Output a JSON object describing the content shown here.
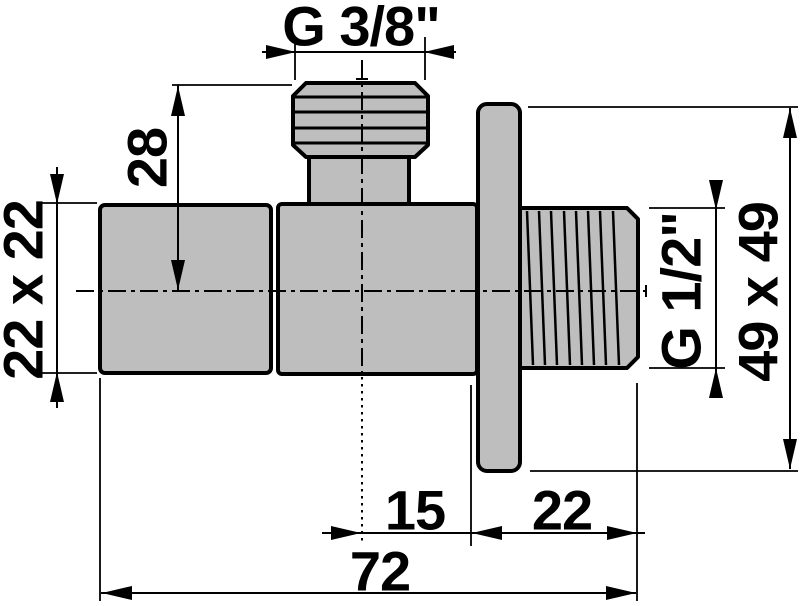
{
  "drawing": {
    "title": "Angle valve technical drawing",
    "labels": {
      "thread_top": "G 3/8\"",
      "dim_height_28": "28",
      "dim_body_22x22": "22 x 22",
      "thread_side": "G 1/2\"",
      "dim_plate_49x49": "49 x 49",
      "dim_offset_15": "15",
      "dim_thread_len_22": "22",
      "dim_total_72": "72"
    },
    "colors": {
      "background": "#ffffff",
      "part_fill": "#bebebe",
      "line": "#000000"
    }
  }
}
